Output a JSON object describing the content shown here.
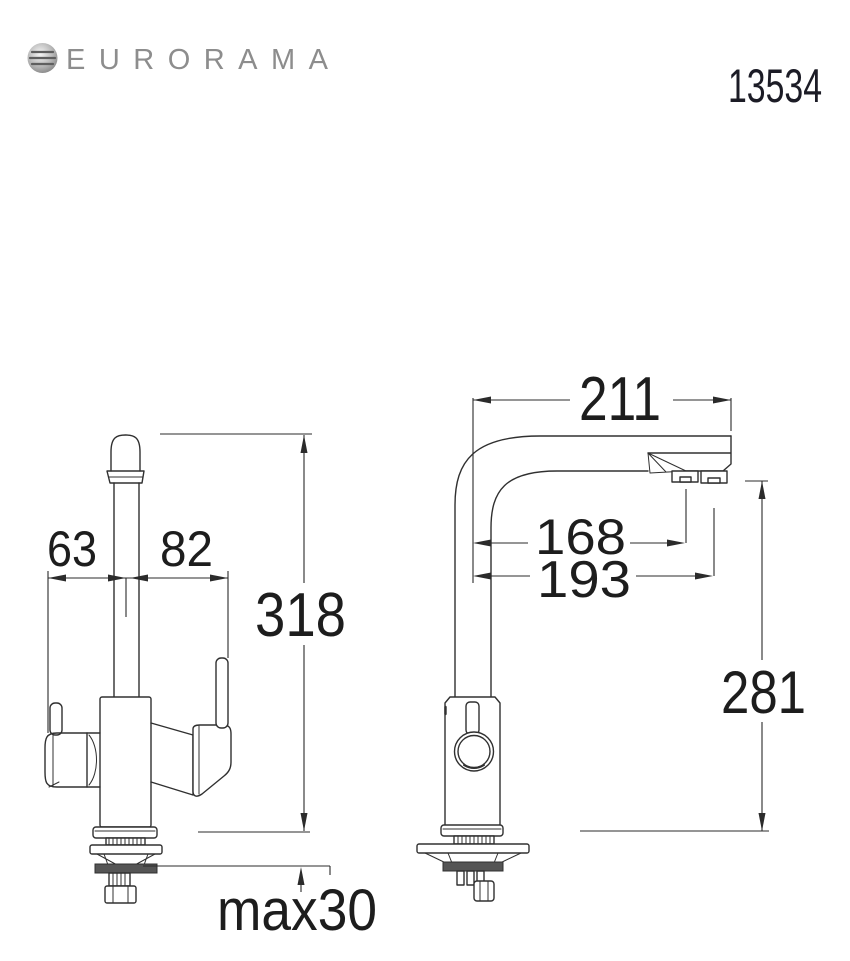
{
  "page": {
    "background": "#ffffff",
    "width": 850,
    "height": 961
  },
  "header": {
    "brand": "EURORAMA",
    "logo_icon": "globe-icon",
    "brand_color": "#8d8d8d",
    "model_number": "13534"
  },
  "drawing": {
    "type": "technical-dimension-drawing",
    "subject": "kitchen mixer tap, front view and side view",
    "line_color": "#303030",
    "text_color": "#1d1d1d",
    "front_view": {
      "dim_left_valve_to_axis": "63",
      "dim_axis_to_handle": "82",
      "dim_total_height": "318",
      "dim_max_deck_thickness": "max30"
    },
    "side_view": {
      "dim_spout_reach": "211",
      "dim_outlet_1_offset": "168",
      "dim_outlet_2_offset": "193",
      "dim_height_above_deck": "281"
    }
  }
}
